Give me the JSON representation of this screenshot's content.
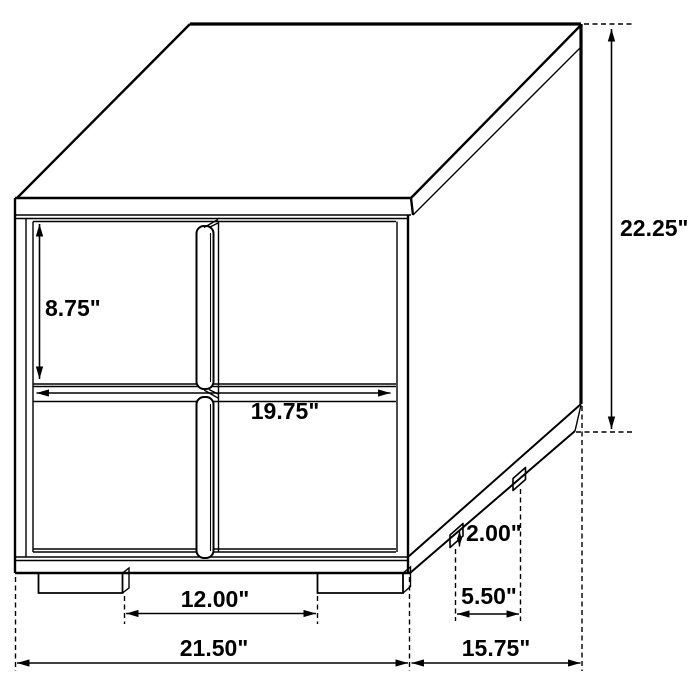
{
  "page": {
    "background_color": "#ffffff",
    "ink_color": "#000000"
  },
  "diagram": {
    "type": "furniture-dimension-drawing",
    "subject": "two-drawer nightstand, three-quarter line view with dimension callouts",
    "labels": {
      "drawer_height": "8.75\"",
      "drawer_width": "19.75\"",
      "overall_height": "22.25\"",
      "foot_height": "2.00\"",
      "side_foot_spacing": "5.50\"",
      "front_foot_spacing": "12.00\"",
      "overall_width": "21.50\"",
      "overall_depth": "15.75\""
    }
  }
}
